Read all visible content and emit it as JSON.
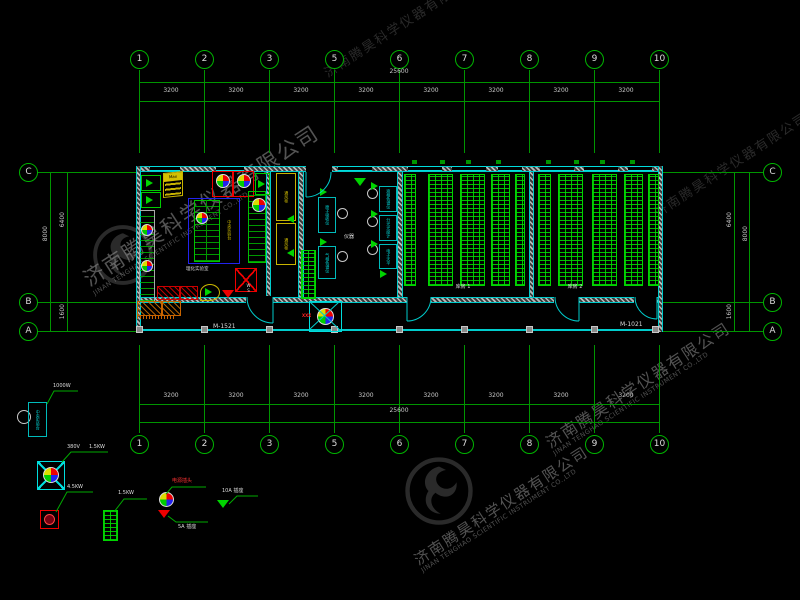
{
  "watermark": {
    "cn": "济南腾昊科学仪器有限公司",
    "en": "JINAN TENGHAO SCIENTIFIC INSTRUMENT CO.,LTD"
  },
  "axes": {
    "cols": [
      "1",
      "2",
      "3",
      "5",
      "6",
      "7",
      "8",
      "9",
      "10"
    ],
    "rows": [
      "C",
      "B",
      "A"
    ]
  },
  "dims": {
    "top_total": "25600",
    "bottom_total": "25600",
    "seg": "3200",
    "side_total": "8000",
    "side_upper": "6400",
    "side_lower": "1600"
  },
  "plan": {
    "door_left": "M-1521",
    "door_right": "M-1021",
    "room_lab": "理化实验室",
    "room_instr": "仪器",
    "room_store1": "库房 1",
    "room_store2": "库房 2",
    "bench_center": "中央实验台",
    "cabinet": "通风柜",
    "hood": "Max",
    "shaft": "XXX",
    "ws": "WS",
    "instruments": [
      "原子吸收仪",
      "气相色谱仪",
      "液相色谱仪",
      "分光光度计",
      "电子天平"
    ]
  },
  "legend": {
    "box": "中央实验台",
    "item1": "1000W",
    "item2a": "380V",
    "item2b": "1.5KW",
    "item3": "4.5KW",
    "item4": "1.5KW",
    "item5": "电源插头",
    "item6": "5A 插座",
    "item7": "10A 插座"
  }
}
